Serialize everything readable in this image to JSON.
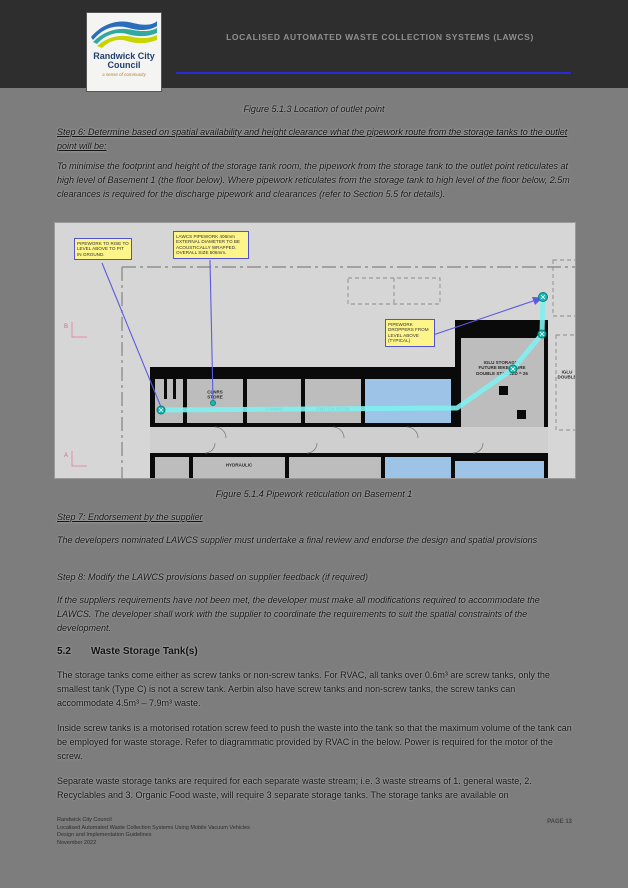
{
  "header": {
    "title": "LOCALISED AUTOMATED WASTE COLLECTION SYSTEMS (LAWCS)",
    "logo": {
      "name": "Randwick City\nCouncil",
      "tagline": "a sense of community"
    },
    "accent_rule_color": "#2b2bd6"
  },
  "captions": {
    "figure_top": "Figure 5.1.3 Location of outlet point",
    "figure_bottom": "Figure 5.1.4 Pipework reticulation on Basement 1"
  },
  "paragraphs": {
    "step6": "Step 6: Determine based on spatial availability and height clearance what the pipework route from the storage tanks to the outlet point will be:",
    "p_minimise": "To minimise the footprint and height of the storage tank room, the pipework from the storage tank to the outlet point reticulates at high level of Basement 1 (the floor below). Where pipework reticulates from the storage tank to high level of the floor below, 2.5m clearances is required for the discharge pipework and clearances (refer to Section 5.5 for details).",
    "step7": "Step 7: Endorsement by the supplier",
    "p_endorse": "The developers nominated LAWCS supplier must undertake a final review and endorse the design and spatial provisions",
    "step8": "Step 8: Modify the LAWCS provisions based on supplier feedback (if required)",
    "p_modify": "If the suppliers requirements have not been met, the developer must make all modifications required to accommodate the LAWCS. The developer shall work with the supplier to coordinate the requirements to suit the spatial constraints of the development.",
    "p_tanks1": "The storage tanks come either as screw tanks or non-screw tanks. For RVAC, all tanks over 0.6m³ are screw tanks, only the smallest tank (Type C) is not a screw tank. Aerbin also have screw tanks and non-screw tanks, the screw tanks can accommodate 4.5m³ – 7.9m³ waste.",
    "p_tanks2": "Inside screw tanks is a motorised rotation screw feed to push the waste into the tank so that the maximum volume of the tank can be employed for waste storage. Refer to diagrammatic provided by RVAC in the below. Power is required for the motor of the screw.",
    "p_tanks3": "Separate waste storage tanks are required for each separate waste stream; i.e. 3 waste streams of 1. general waste, 2. Recyclables and 3. Organic Food waste, will require 3 separate storage tanks. The storage tanks are available on"
  },
  "section": {
    "number": "5.2",
    "title": "Waste Storage Tank(s)"
  },
  "diagram": {
    "callouts": [
      {
        "text": "PIPEWORK TO RISE TO LEVEL ABOVE TO PIT IN GROUND."
      },
      {
        "text": "LAWCS PIPEWORK 406mm EXTERNAL DIAMETER TO BE ACOUSTICALLY WRAPPED. OVERALL SIZE 506mm."
      },
      {
        "text": "PIPEWORK DROPPERS FROM LEVEL ABOVE (TYPICAL)"
      }
    ],
    "rooms": [
      {
        "label": "CLNRS\nSTORE"
      },
      {
        "label": "COMMS"
      },
      {
        "label": "SWITCH ROOM"
      },
      {
        "label": "IGLU STORAGE /\nFUTURE BIKE STORE\nDOUBLE STACKED = 26"
      },
      {
        "label": "IGLU\nDOUBLE"
      },
      {
        "label": "HYDRAULIC"
      }
    ],
    "axis_markers": {
      "top": "B",
      "bottom": "A"
    },
    "colors": {
      "pipework": "#7fefef",
      "node": "#17b8b0",
      "callout_fill": "#fdf48a",
      "callout_border": "#5353cf",
      "leader": "#5b5be0",
      "room_fill": "#bdbdbd",
      "room_blue": "#9dc3e6",
      "wall": "#0a0a0a",
      "axis_pink": "#e48ca4"
    }
  },
  "footer": {
    "lines": "Randwick City Council\nLocalised Automated Waste Collection Systems Using Mobile Vacuum Vehicles\nDesign and Implementation Guidelines\nNovember 2022",
    "page": "PAGE 13"
  }
}
